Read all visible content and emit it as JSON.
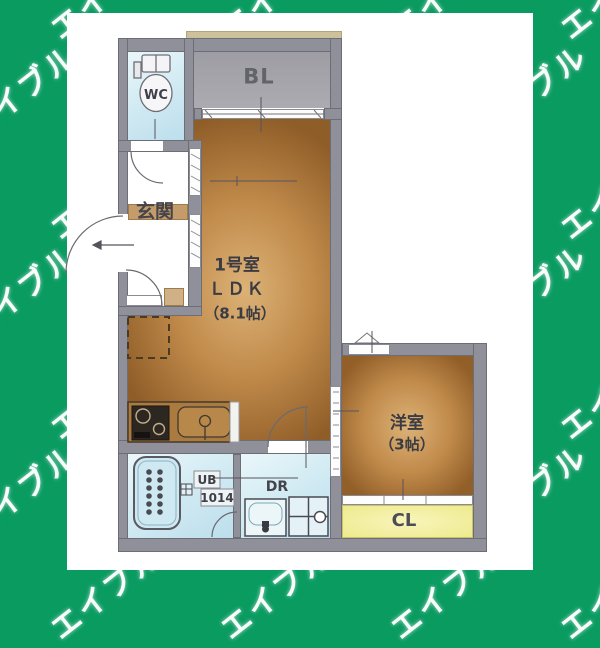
{
  "background": {
    "watermark_text": "エイブル",
    "green": "#0a9b61"
  },
  "floor_plan": {
    "unit_title": {
      "line1": "1号室",
      "line2": "ＬＤＫ",
      "line3": "（8.1帖）"
    },
    "rooms": {
      "wc": "WC",
      "balcony": "BL",
      "entrance": "玄関",
      "bath_line1": "UB",
      "bath_line2": "1014",
      "washroom": "DR",
      "western_line1": "洋室",
      "western_line2": "（3帖）",
      "closet": "CL"
    },
    "colors": {
      "wall": "#90909a",
      "wood_floor_light": "#dcb277",
      "wood_floor_dark": "#8f5d28",
      "wet_area_floor": "#cfe9f2",
      "balcony_floor": "#a5a5ab",
      "closet_yellow": "#eeea8e",
      "entrance_tan": "#c49c6c"
    }
  }
}
